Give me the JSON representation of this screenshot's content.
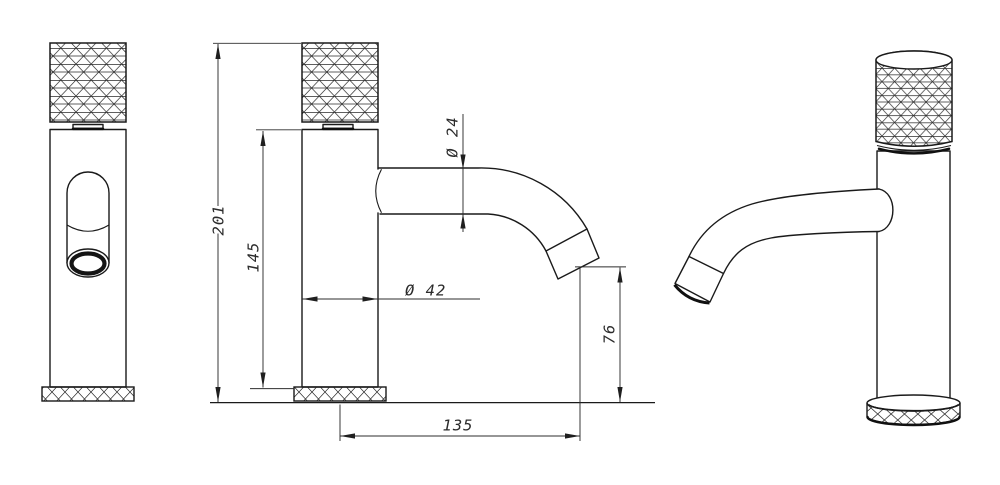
{
  "drawing": {
    "background_color": "#ffffff",
    "line_color": "#1a1a1a",
    "dimension_color": "#2e2e2e",
    "dimensions": {
      "total_height": "201",
      "body_height": "145",
      "body_diameter": "Ø 42",
      "spout_diameter": "Ø 24",
      "spout_clearance": "76",
      "spout_reach": "135"
    }
  }
}
